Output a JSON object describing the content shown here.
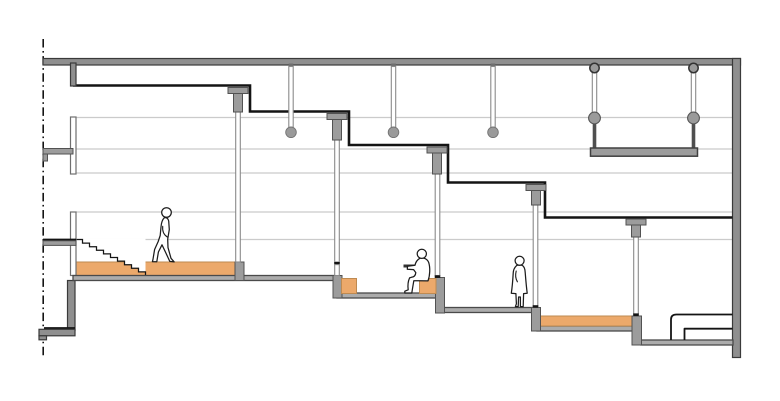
{
  "meta": {
    "kind": "architectural-section-drawing",
    "width": 780,
    "height": 401
  },
  "colors": {
    "paper": "#ffffff",
    "ink": "#141414",
    "guide": "#cbcbcb",
    "structure": "#8f8f8f",
    "structure_edge": "#3a3a3a",
    "floor_fill": "#acacac",
    "floor_edge": "#4a4a4a",
    "block": "#9c9c9c",
    "block_edge": "#525252",
    "column_edge": "#8a8a8a",
    "orange": "#ECA96B",
    "orange_edge": "#BE8A51",
    "circle_gray": "#9a9a9a",
    "hanger_dark": "#4f4f4f",
    "figure": "#1c1c1c"
  },
  "scene": {
    "terraced_levels": 5,
    "stair_steps": 10,
    "pendant_lights": 3,
    "suspended_platforms": 1,
    "structural_columns": 5,
    "guideline_count": 5,
    "figures": [
      {
        "name": "walking-person",
        "pose": "walking",
        "level": 1
      },
      {
        "name": "seated-person",
        "pose": "seated-reading",
        "level": 2
      },
      {
        "name": "standing-person",
        "pose": "standing",
        "level": 3
      }
    ],
    "furniture": [
      "bed"
    ],
    "orange_finish_slabs": 2,
    "orange_seat_cubes": 2
  }
}
